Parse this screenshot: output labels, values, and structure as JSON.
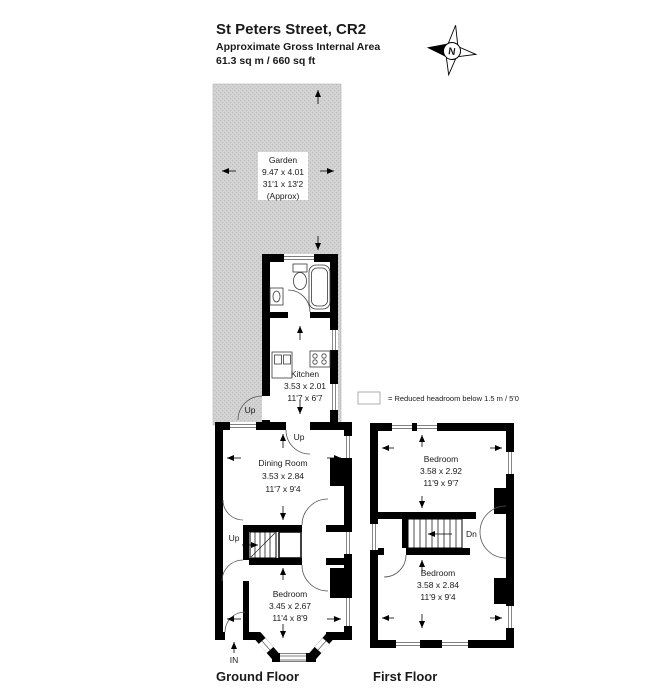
{
  "header": {
    "title": "St Peters Street, CR2",
    "subtitle": "Approximate Gross Internal Area",
    "area": "61.3 sq m / 660 sq ft"
  },
  "compass": {
    "label": "N"
  },
  "legend": {
    "text": "=  Reduced headroom below 1.5 m / 5'0"
  },
  "garden": {
    "name": "Garden",
    "metric": "9.47 x 4.01",
    "imperial": "31'1 x 13'2",
    "note": "(Approx)"
  },
  "ground_floor": {
    "label": "Ground Floor",
    "kitchen": {
      "name": "Kitchen",
      "metric": "3.53 x 2.01",
      "imperial": "11'7 x 6'7"
    },
    "dining": {
      "name": "Dining Room",
      "metric": "3.53 x 2.84",
      "imperial": "11'7 x 9'4"
    },
    "bedroom": {
      "name": "Bedroom",
      "metric": "3.45 x 2.67",
      "imperial": "11'4 x 8'9"
    },
    "stair_garden": "Up",
    "stair_kitchen": "Up",
    "stair_main": "Up",
    "entrance": "IN"
  },
  "first_floor": {
    "label": "First Floor",
    "bedroom_rear": {
      "name": "Bedroom",
      "metric": "3.58 x 2.92",
      "imperial": "11'9 x 9'7"
    },
    "bedroom_front": {
      "name": "Bedroom",
      "metric": "3.58 x 2.84",
      "imperial": "11'9 x 9'4"
    },
    "stair": "Dn"
  },
  "colors": {
    "wall": "#000000",
    "garden": "#d2d2d2",
    "background": "#ffffff"
  }
}
